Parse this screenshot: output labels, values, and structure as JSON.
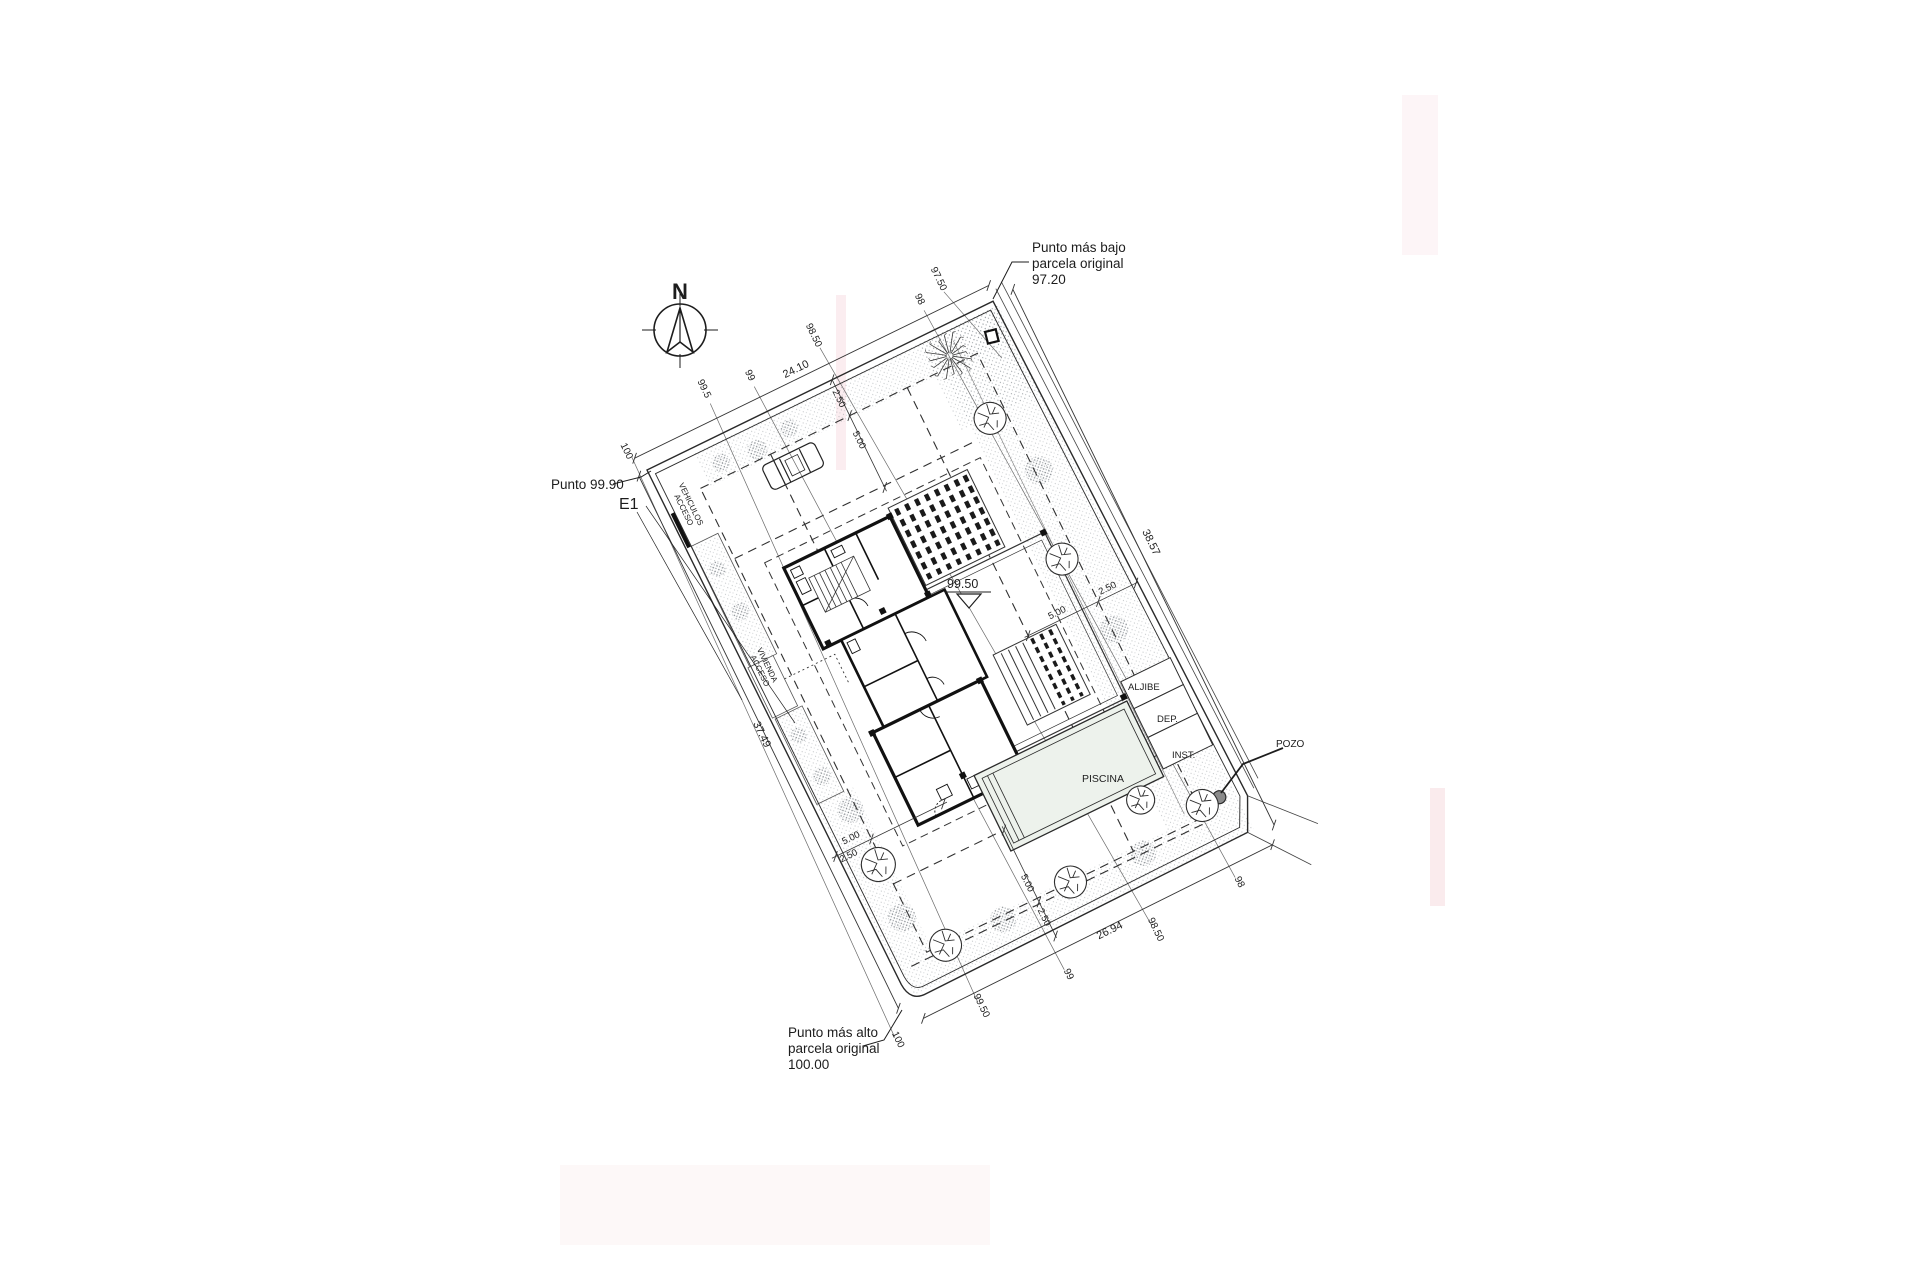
{
  "title": "Plano de situación / emplazamiento",
  "colors": {
    "line": "#2a2a2a",
    "thin": "#5a5a5a",
    "stipple": "#7d848a",
    "pool_fill": "#edf2ec",
    "scan_pink": "#f3ccd3",
    "well_fill": "#8a8a8a"
  },
  "north": {
    "label": "N"
  },
  "annotations": {
    "punto_bajo_1": "Punto más bajo",
    "punto_bajo_2": "parcela original",
    "punto_bajo_3": "97.20",
    "punto_alto_1": "Punto más alto",
    "punto_alto_2": "parcela original",
    "punto_alto_3": "100.00",
    "punto_9990": "Punto 99.90",
    "section_mark": "E1",
    "piscina": "PISCINA",
    "aljibe": "ALJIBE",
    "dep": "DEP.",
    "inst": "INST.",
    "pozo": "POZO",
    "house_level": "99.50"
  },
  "dimensions": {
    "top_edge": "24.10",
    "right_edge": "38.57",
    "left_edge": "37.49",
    "bottom_edge": "26.94"
  },
  "plan": {
    "rot_labels": [
      {
        "t": "24.10",
        "x": 178,
        "y": -22,
        "r": 0,
        "fs": 11
      },
      {
        "t": "26.94",
        "x": 214,
        "y": 620,
        "r": 0,
        "fs": 11
      },
      {
        "t": "38.57",
        "x": 418,
        "y": 286,
        "r": 90,
        "fs": 11
      },
      {
        "t": "37.49",
        "x": -16,
        "y": 288,
        "r": 90,
        "fs": 11
      },
      {
        "t": "100",
        "x": -13,
        "y": -26,
        "r": 90,
        "fs": 10
      },
      {
        "t": "99.5",
        "x": 84,
        "y": -48,
        "r": 90,
        "fs": 10
      },
      {
        "t": "99",
        "x": 131,
        "y": -40,
        "r": 90,
        "fs": 10
      },
      {
        "t": "98.50",
        "x": 206,
        "y": -48,
        "r": 90,
        "fs": 10
      },
      {
        "t": "98",
        "x": 317,
        "y": -34,
        "r": 90,
        "fs": 10
      },
      {
        "t": "97.50",
        "x": 343,
        "y": -44,
        "r": 90,
        "fs": 10
      },
      {
        "t": "100",
        "x": -27,
        "y": 622,
        "r": 90,
        "fs": 10
      },
      {
        "t": "99.50",
        "x": 63,
        "y": 628,
        "r": 90,
        "fs": 10
      },
      {
        "t": "99",
        "x": 155,
        "y": 638,
        "r": 90,
        "fs": 10
      },
      {
        "t": "98.50",
        "x": 253,
        "y": 636,
        "r": 90,
        "fs": 10
      },
      {
        "t": "98",
        "x": 349,
        "y": 630,
        "r": 90,
        "fs": 10
      },
      {
        "t": "2.50",
        "x": 201,
        "y": 20,
        "r": 90,
        "fs": 9.5
      },
      {
        "t": "5.00",
        "x": 201,
        "y": 66,
        "r": 90,
        "fs": 9.5
      },
      {
        "t": "5.00",
        "x": 306,
        "y": 311,
        "r": 0,
        "fs": 9.5
      },
      {
        "t": "2.50",
        "x": 362,
        "y": 311,
        "r": 0,
        "fs": 9.5
      },
      {
        "t": "5.00",
        "x": 158,
        "y": 538,
        "r": 90,
        "fs": 9.5
      },
      {
        "t": "2.50",
        "x": 158,
        "y": 576,
        "r": 90,
        "fs": 9.5
      },
      {
        "t": "5.00",
        "x": 22,
        "y": 423,
        "r": 0,
        "fs": 9.5
      },
      {
        "t": "2.50",
        "x": 12,
        "y": 438,
        "r": 0,
        "fs": 9.5
      },
      {
        "t": "ACCESO",
        "x": 13,
        "y": 52,
        "r": 90,
        "fs": 8
      },
      {
        "t": "VEHICULOS",
        "x": 22,
        "y": 50,
        "r": 90,
        "fs": 8
      },
      {
        "t": "ACCESO",
        "x": 11,
        "y": 230,
        "r": 90,
        "fs": 8
      },
      {
        "t": "VIVIENDA",
        "x": 20,
        "y": 228,
        "r": 90,
        "fs": 8
      }
    ],
    "screen_labels": [
      {
        "t": "N",
        "x": 680,
        "y": 299,
        "fs": 22,
        "a": "m",
        "b": "north.label",
        "bold": true
      },
      {
        "t": "Punto 99.90",
        "x": 551,
        "y": 489,
        "fs": 13.5,
        "b": "annotations.punto_9990"
      },
      {
        "t": "E1",
        "x": 619,
        "y": 509,
        "fs": 16,
        "b": "annotations.section_mark"
      },
      {
        "t": "Punto más bajo",
        "x": 1032,
        "y": 252,
        "fs": 13.5,
        "b": "annotations.punto_bajo_1"
      },
      {
        "t": "parcela original",
        "x": 1032,
        "y": 268,
        "fs": 13.5,
        "b": "annotations.punto_bajo_2"
      },
      {
        "t": "97.20",
        "x": 1032,
        "y": 284,
        "fs": 13.5,
        "b": "annotations.punto_bajo_3"
      },
      {
        "t": "Punto más alto",
        "x": 788,
        "y": 1037,
        "fs": 13.5,
        "b": "annotations.punto_alto_1"
      },
      {
        "t": "parcela original",
        "x": 788,
        "y": 1053,
        "fs": 13.5,
        "b": "annotations.punto_alto_2"
      },
      {
        "t": "100.00",
        "x": 788,
        "y": 1069,
        "fs": 13.5,
        "b": "annotations.punto_alto_3"
      },
      {
        "t": "PISCINA",
        "x": 1082,
        "y": 782,
        "fs": 10.5,
        "b": "annotations.piscina"
      },
      {
        "t": "ALJIBE",
        "x": 1128,
        "y": 690,
        "fs": 9.5,
        "b": "annotations.aljibe"
      },
      {
        "t": "DEP.",
        "x": 1157,
        "y": 722,
        "fs": 9.5,
        "b": "annotations.dep"
      },
      {
        "t": "INST.",
        "x": 1172,
        "y": 758,
        "fs": 9.5,
        "b": "annotations.inst"
      },
      {
        "t": "POZO",
        "x": 1276,
        "y": 747,
        "fs": 10,
        "b": "annotations.pozo"
      },
      {
        "t": "99.50",
        "x": 947,
        "y": 588,
        "fs": 12.5,
        "b": "annotations.house_level"
      }
    ],
    "contour_lines": [
      [
        -8,
        -18,
        -26,
        618
      ],
      [
        86,
        -32,
        64,
        622
      ],
      [
        133,
        -28,
        156,
        632
      ],
      [
        209,
        -34,
        254,
        630
      ],
      [
        319,
        -22,
        350,
        624
      ],
      [
        345,
        -30,
        368,
        55
      ]
    ],
    "trees": [
      {
        "k": "fuzzy",
        "x": 70,
        "y": 26,
        "s": 9
      },
      {
        "k": "fuzzy",
        "x": 108,
        "y": 30,
        "s": 10
      },
      {
        "k": "fuzzy",
        "x": 146,
        "y": 25,
        "s": 9
      },
      {
        "k": "spiky",
        "x": 322,
        "y": 30,
        "s": 24
      },
      {
        "k": "round",
        "x": 331,
        "y": 104,
        "s": 16
      },
      {
        "k": "fuzzy",
        "x": 352,
        "y": 172,
        "s": 14
      },
      {
        "k": "round",
        "x": 334,
        "y": 262,
        "s": 16
      },
      {
        "k": "fuzzy",
        "x": 350,
        "y": 348,
        "s": 14
      },
      {
        "k": "fuzzy",
        "x": 20,
        "y": 120,
        "s": 8
      },
      {
        "k": "fuzzy",
        "x": 22,
        "y": 168,
        "s": 9
      },
      {
        "k": "fuzzy",
        "x": 20,
        "y": 305,
        "s": 8
      },
      {
        "k": "fuzzy",
        "x": 23,
        "y": 352,
        "s": 9
      },
      {
        "k": "fuzzy",
        "x": 34,
        "y": 395,
        "s": 13
      },
      {
        "k": "round",
        "x": 35,
        "y": 456,
        "s": 17
      },
      {
        "k": "fuzzy",
        "x": 33,
        "y": 514,
        "s": 14
      },
      {
        "k": "round",
        "x": 60,
        "y": 558,
        "s": 16
      },
      {
        "k": "fuzzy",
        "x": 123,
        "y": 560,
        "s": 13
      },
      {
        "k": "round",
        "x": 200,
        "y": 556,
        "s": 16
      },
      {
        "k": "fuzzy",
        "x": 278,
        "y": 562,
        "s": 13
      },
      {
        "k": "round",
        "x": 299,
        "y": 513,
        "s": 14
      },
      {
        "k": "round",
        "x": 352,
        "y": 545,
        "s": 16
      }
    ]
  }
}
